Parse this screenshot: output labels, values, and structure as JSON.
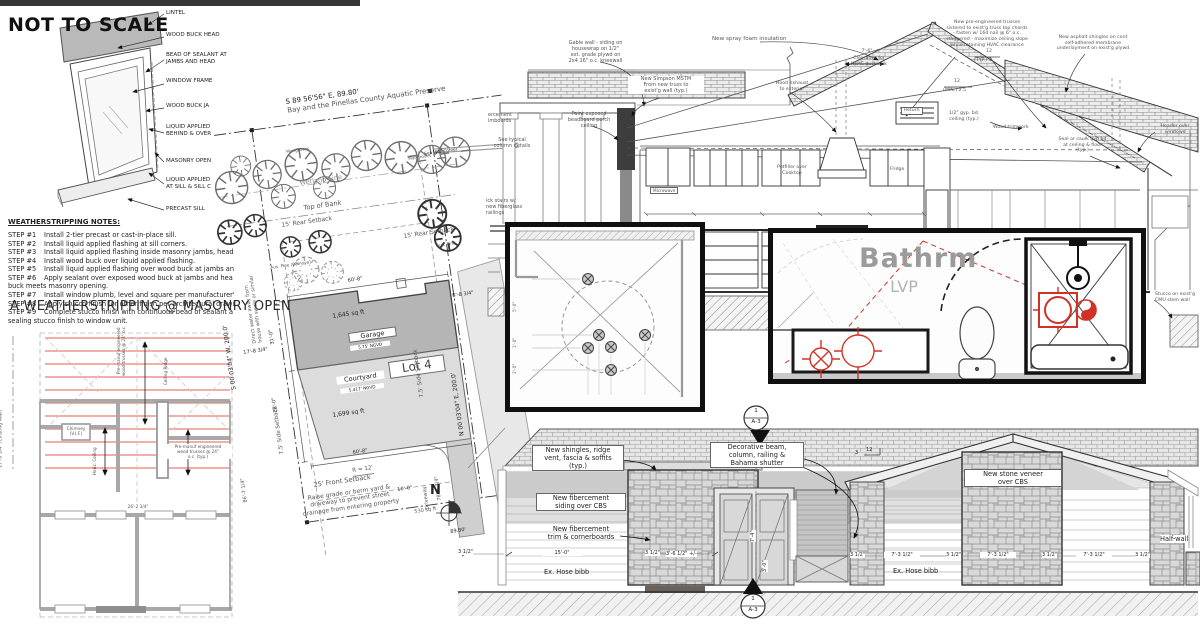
{
  "window_detail": {
    "heading": "NOT TO SCALE",
    "callouts": {
      "lintel": "LINTEL",
      "wood_buck_head": "WOOD BUCK HEAD",
      "bead_sealant": "BEAD OF SEALANT AT\nJAMBS AND HEAD",
      "window_frame": "WINDOW FRAME",
      "wood_buck_jamb": "WOOD BUCK JA",
      "liquid_applied_jamb": "LIQUID APPLIED\nBEHIND & OVER",
      "masonry_opening": "MASONRY OPEN",
      "liquid_applied_sill": "LIQUID APPLIED\nAT SILL & SILL C",
      "precast_sill": "PRECAST SILL"
    }
  },
  "weatherstripping": {
    "heading": "WEATHERSTRIPPING NOTES:",
    "steps": [
      {
        "label": "STEP #1",
        "text": "Install 2-tier precast or cast-in-place sill."
      },
      {
        "label": "STEP #2",
        "text": "Install liquid applied flashing at sill corners."
      },
      {
        "label": "STEP #3",
        "text": "Install liquid applied flashing inside masonry jambs, head"
      },
      {
        "label": "STEP #4",
        "text": "Install wood buck over liquid applied flashing."
      },
      {
        "label": "STEP #5",
        "text": "Install liquid applied flashing over wood buck at jambs an"
      },
      {
        "label": "STEP #6",
        "text": "Apply sealant over exposed wood buck at jambs and hea"
      },
      {
        "label": "STEP #7",
        "text": "Install window plumb, level and square per manufacturer'"
      },
      {
        "label": "STEP #8",
        "text": "Apply stucco finish (or other finish per architectural drawi"
      },
      {
        "label": "STEP #9",
        "text": "Complete stucco finish with continuous bead of sealant a"
      }
    ],
    "cont_step6": "buck meets masonry opening.",
    "cont_step9": "sealing stucco finish to window unit.",
    "detail_title": "A  WEATHERSTRIPPING @ MASONRY OPEN"
  },
  "framing_plan": {
    "existing_wall_dim": "27'-9 3/4\" (Existing Wall)",
    "truss_note_vert": "Pre-manuf engineered\nwood trusses @ 24\" o.c.",
    "ceiling_ridge": "Ceiling Ridge",
    "chimney": "Chimney\n(V.I.F.)",
    "horiz_ceiling": "Horiz. Ceiling",
    "truss_note": "Pre-manuf engineered\nwood trusses @ 24\"\no.c. (typ.)",
    "dim_26": "26'-2 3/4\""
  },
  "site_plan": {
    "bearing_top": "S 89 56'56\" E, 89.80'",
    "preserve": "Bay and the Pinellas County Aquatic Preserve",
    "mangroves": "Mangroves",
    "sea_wall_corner": "Sea Wall Corner",
    "wetland_line": "Wetland Line",
    "top_of_bank": "Top of Bank",
    "rear_setback": "15' Rear Setback",
    "aus_pine_remove": "Aus. Pine (Remove)",
    "aus_pine": "Aus. Pine",
    "dim_60_8": "60'-8\"",
    "dim_8_8": "8'-8 3/4\"",
    "garage_sqft": "1,645 sq ft",
    "garage": "Garage",
    "garage_ngvd": "5.75' NGVD",
    "lot": "Lot 4",
    "dim_31": "31'-0\"",
    "dim_17_8": "17'-8 3/4\"",
    "dim_28": "28'-0\"",
    "courtyard": "Courtyard",
    "courtyard_ngvd": "5.417' NGVD",
    "courtyard_sqft": "1,699 sq ft",
    "r12": "R = 12'",
    "driveway": "Driveway",
    "drive_sqft": "530 sq ft",
    "dim_86": "86'-7 1/4\"",
    "dim_78": "78'-5 3/4\"",
    "dim_10": "10'-0\"",
    "front_setback": "25' Front Setback",
    "raise_grade": "Raise grade or berm yard &\ndriveway to prevent street\ndrainage from entering property",
    "boundary_w": "S 00 03'04\" W, 200.0'",
    "boundary_e": "N 00 03'04\" E, 200.0'",
    "side_setback": "7.5' Side Setback",
    "direct_water": "Direct water away from\nhouse with swale or similar",
    "north": "N",
    "bearing_bottom": "89.80'"
  },
  "section": {
    "gable_wall_note": "Gable wall - siding on\nhousewrap on 1/2\"\next. grade plywd on\n2x4 16\" o.c. kneewall",
    "simpson_note": "New Simpson MSTM\nFrom new truss to\nexist'g wall (typ.)",
    "spray_foam": "New spray foam insulation",
    "beadboard": "Paint exposed\nbeadboard porch\nceiling",
    "fibercement_cut": "ercement\nimboards",
    "column_details": "See typical\ncolumn details",
    "stairs_note": "ick stairs w/\nnew fiberglass\nrailings",
    "trusses_note": "New pre-engineered trusses\nsistered to exist'g truss top chords\n- fasten w/ 16d nail @ 6\" o.c.\nstaggered - maximize ceiling slope\nwhile retaining HVAC clearance",
    "shingles_note": "New asphalt shingles on cont\nself-adhered membrane\nunderlayment on exist'g plywd",
    "clearance_dim": "7'-6\"",
    "clearance_note": "Clearance for\nHVAC ductwork",
    "hood_exhaust": "Hood exhaust\nto exterior",
    "slope_top": "12",
    "slope_typ": "(TYP.)  5",
    "slope_min": "(MIN.) 2.5",
    "return_label": "Return",
    "gyp_ceiling": "1/2\" gyp. bd.\nceiling (typ.)",
    "wood_trimwork": "Wood trimwork",
    "seal_caulk": "Seal or caulk gyp bd\nat ceiling & floor\n(typ.)",
    "header_over": "Header over\nwindows",
    "stucco_stem": "Stucco on exist'g\nCMU stem wall",
    "microwave": "Microwave",
    "single": "Single",
    "potfiller": "Potfiller over\nCooktop",
    "fridge": "Fridge"
  },
  "ceiling_inset": {
    "dim_5": "5'-0\"",
    "dim_1": "1'-0\"",
    "dim_2": "2'-0\""
  },
  "bathroom_inset": {
    "room_name": "Bathrm",
    "floor_label": "LVP"
  },
  "elevation": {
    "shingles_note": "New shingles, ridge\nvent, fascia & soffits\n(typ.)",
    "siding_note": "New fibercement\nsiding over CBS",
    "trim_note": "New fibercement\ntrim & cornerboards",
    "decorative_note": "Decorative beam,\ncolumn, railing &\nBahama shutter",
    "stone_note": "New stone veneer\nover CBS",
    "half_wall": "Half-wall",
    "hose_bibb": "Ex. Hose bibb",
    "marker": {
      "num": "1",
      "sheet": "A-3"
    },
    "slope_rise": "3",
    "slope_run": "12",
    "dims": {
      "d35": "3 1/2\"",
      "d15": "15'-0\"",
      "d36": "3'-6 1/2\" +/-",
      "d73": "7'-3 1/2\""
    },
    "door_h": "7'-4\"",
    "rail_h": "3'-0\""
  }
}
